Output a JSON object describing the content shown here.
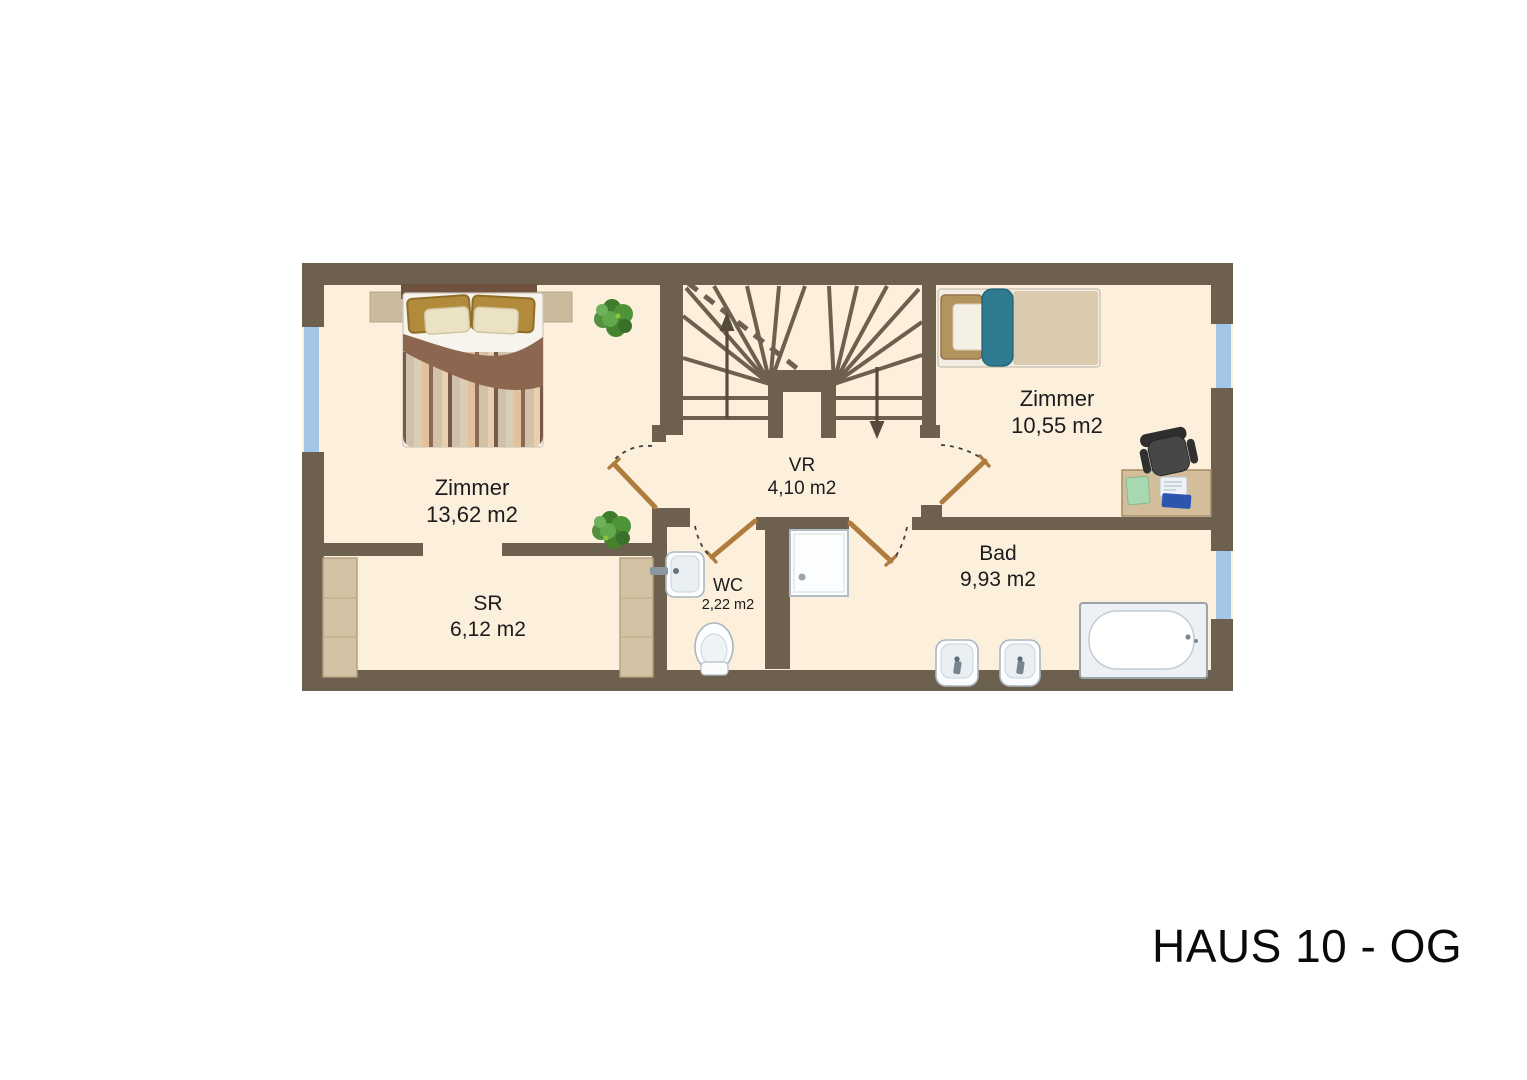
{
  "title": "HAUS 10 - OG",
  "rooms": [
    {
      "name": "Zimmer",
      "area": "13,62 m2"
    },
    {
      "name": "SR",
      "area": "6,12 m2"
    },
    {
      "name": "WC",
      "area": "2,22 m2"
    },
    {
      "name": "VR",
      "area": "4,10 m2"
    },
    {
      "name": "Zimmer",
      "area": "10,55 m2"
    },
    {
      "name": "Bad",
      "area": "9,93 m2"
    }
  ],
  "colors": {
    "wall": "#6e604e",
    "floor": "#fcf0dd",
    "window": "#a3c6e6",
    "door": "#b07c3e",
    "plant": "#4f9339",
    "background": "#ffffff"
  },
  "icons": [
    "double-bed-icon",
    "single-bed-icon",
    "wardrobe-icon",
    "desk-icon",
    "office-chair-icon",
    "bathtub-icon",
    "shower-tray-icon",
    "washbasin-icon",
    "toilet-icon",
    "plant-icon",
    "stairs-up-arrow-icon",
    "stairs-down-arrow-icon",
    "window-icon",
    "door-swing-icon"
  ]
}
